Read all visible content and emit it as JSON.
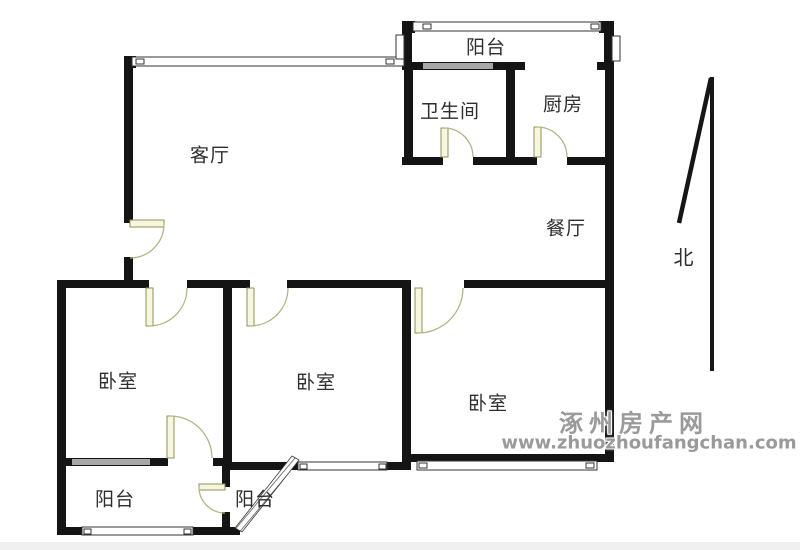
{
  "rooms": {
    "living_room": {
      "label": "客厅"
    },
    "balcony_top": {
      "label": "阳台"
    },
    "bathroom": {
      "label": "卫生间"
    },
    "kitchen": {
      "label": "厨房"
    },
    "dining_room": {
      "label": "餐厅"
    },
    "bedroom_left": {
      "label": "卧室"
    },
    "bedroom_middle": {
      "label": "卧室"
    },
    "bedroom_right": {
      "label": "卧室"
    },
    "balcony_bottom_left": {
      "label": "阳台"
    },
    "balcony_bottom_middle": {
      "label": "阳台"
    }
  },
  "compass": {
    "north_label": "北"
  },
  "watermark": {
    "site_name": "涿州房产网",
    "site_url": "www.zhuozhoufangchan.com"
  },
  "colors": {
    "wall": "#141414",
    "door_leaf": "#f7f7df",
    "door_stroke": "#8f8f58",
    "gray_window": "#a8a8a8",
    "watermark": "#9a9a9a"
  }
}
